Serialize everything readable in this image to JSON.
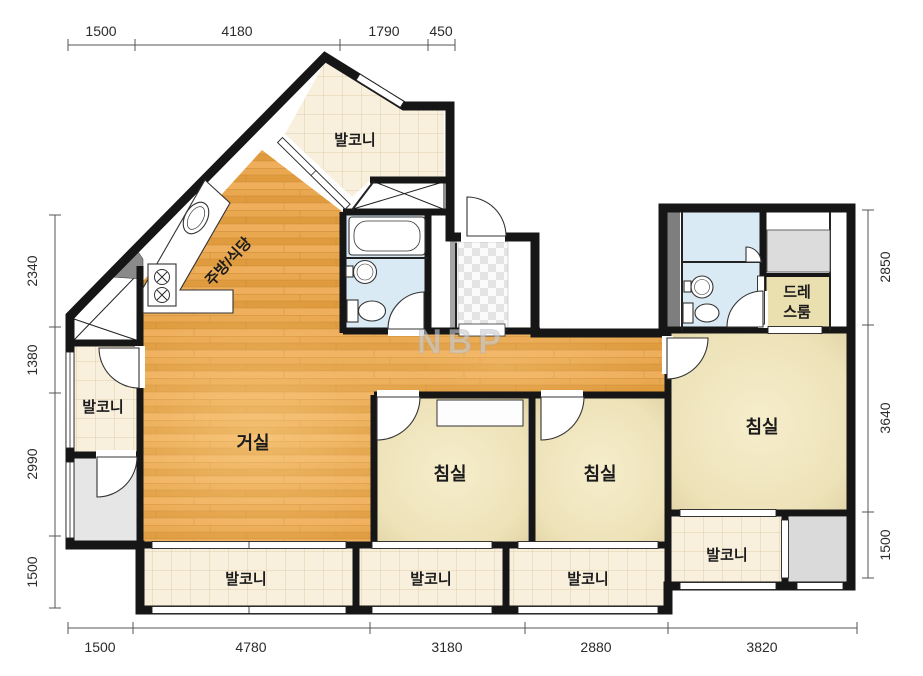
{
  "plan": {
    "watermark": "NBP",
    "rooms": {
      "balcony_top": "발코니",
      "kitchen": "주방/식당",
      "living": "거실",
      "balcony_left": "발코니",
      "bedroom1": "침실",
      "bedroom2": "침실",
      "bedroom_master": "침실",
      "dressroom_line1": "드레",
      "dressroom_line2": "스룸",
      "balcony_bottom1": "발코니",
      "balcony_bottom2": "발코니",
      "balcony_bottom3": "발코니",
      "balcony_bottom4": "발코니"
    },
    "dimensions": {
      "top": [
        "1500",
        "4180",
        "1790",
        "450"
      ],
      "left": [
        "2340",
        "1380",
        "2990",
        "1500"
      ],
      "right": [
        "2850",
        "3640",
        "1500"
      ],
      "bottom": [
        "1500",
        "4780",
        "3180",
        "2880",
        "3820"
      ]
    },
    "colors": {
      "wall": "#161616",
      "wood": "#E8A64D",
      "bedroom": "#EDE2B8",
      "balcony": "#F8F0DD",
      "bathroom": "#D9EAF4",
      "dressroom": "#EADFAF",
      "gray_room": "#E6E6E6",
      "grid_line": "#DFCEAC"
    }
  }
}
